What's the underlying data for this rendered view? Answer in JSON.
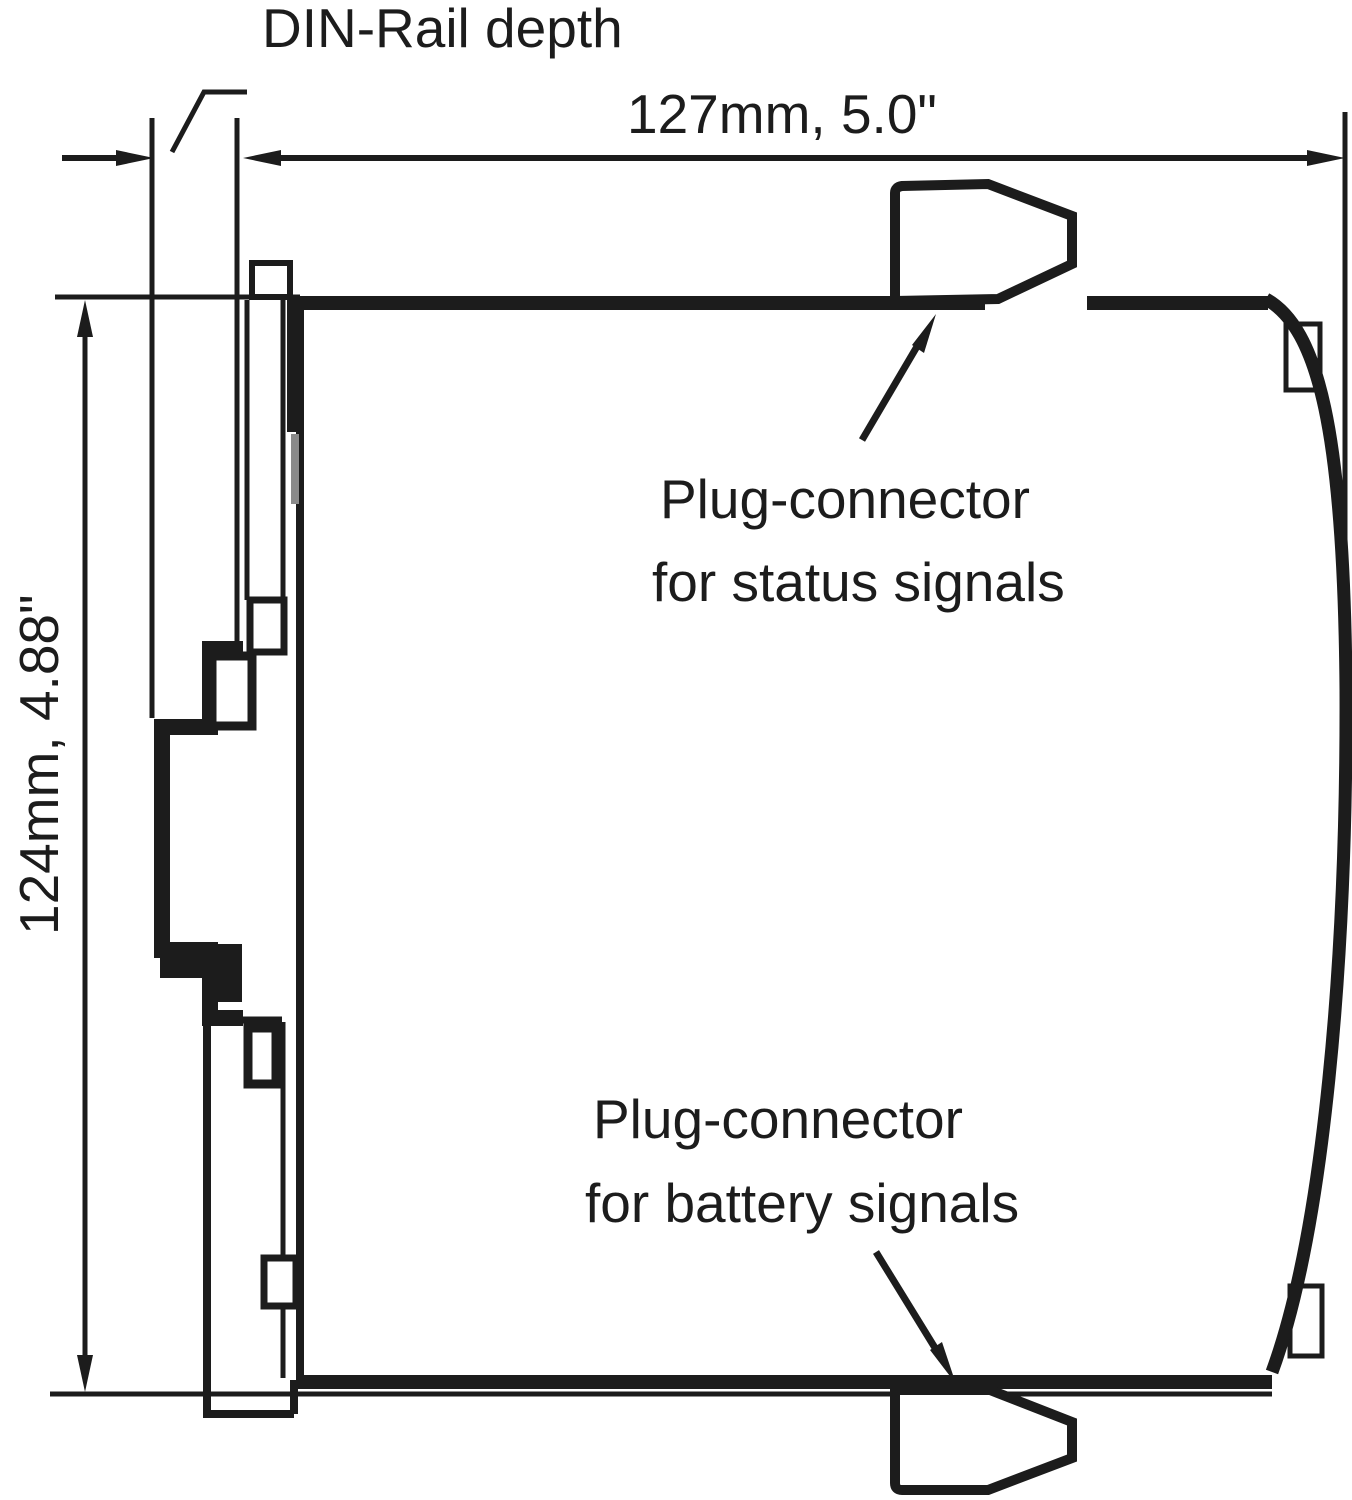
{
  "diagram": {
    "labels": {
      "din_rail_depth": "DIN-Rail depth",
      "width_dimension": "127mm, 5.0\"",
      "height_dimension": "124mm, 4.88\"",
      "status_connector_line1": "Plug-connector",
      "status_connector_line2": "for status signals",
      "battery_connector_line1": "Plug-connector",
      "battery_connector_line2": "for battery signals"
    },
    "colors": {
      "line": "#1c1c1c",
      "background": "#ffffff",
      "shade": "#8a8a8a"
    }
  }
}
